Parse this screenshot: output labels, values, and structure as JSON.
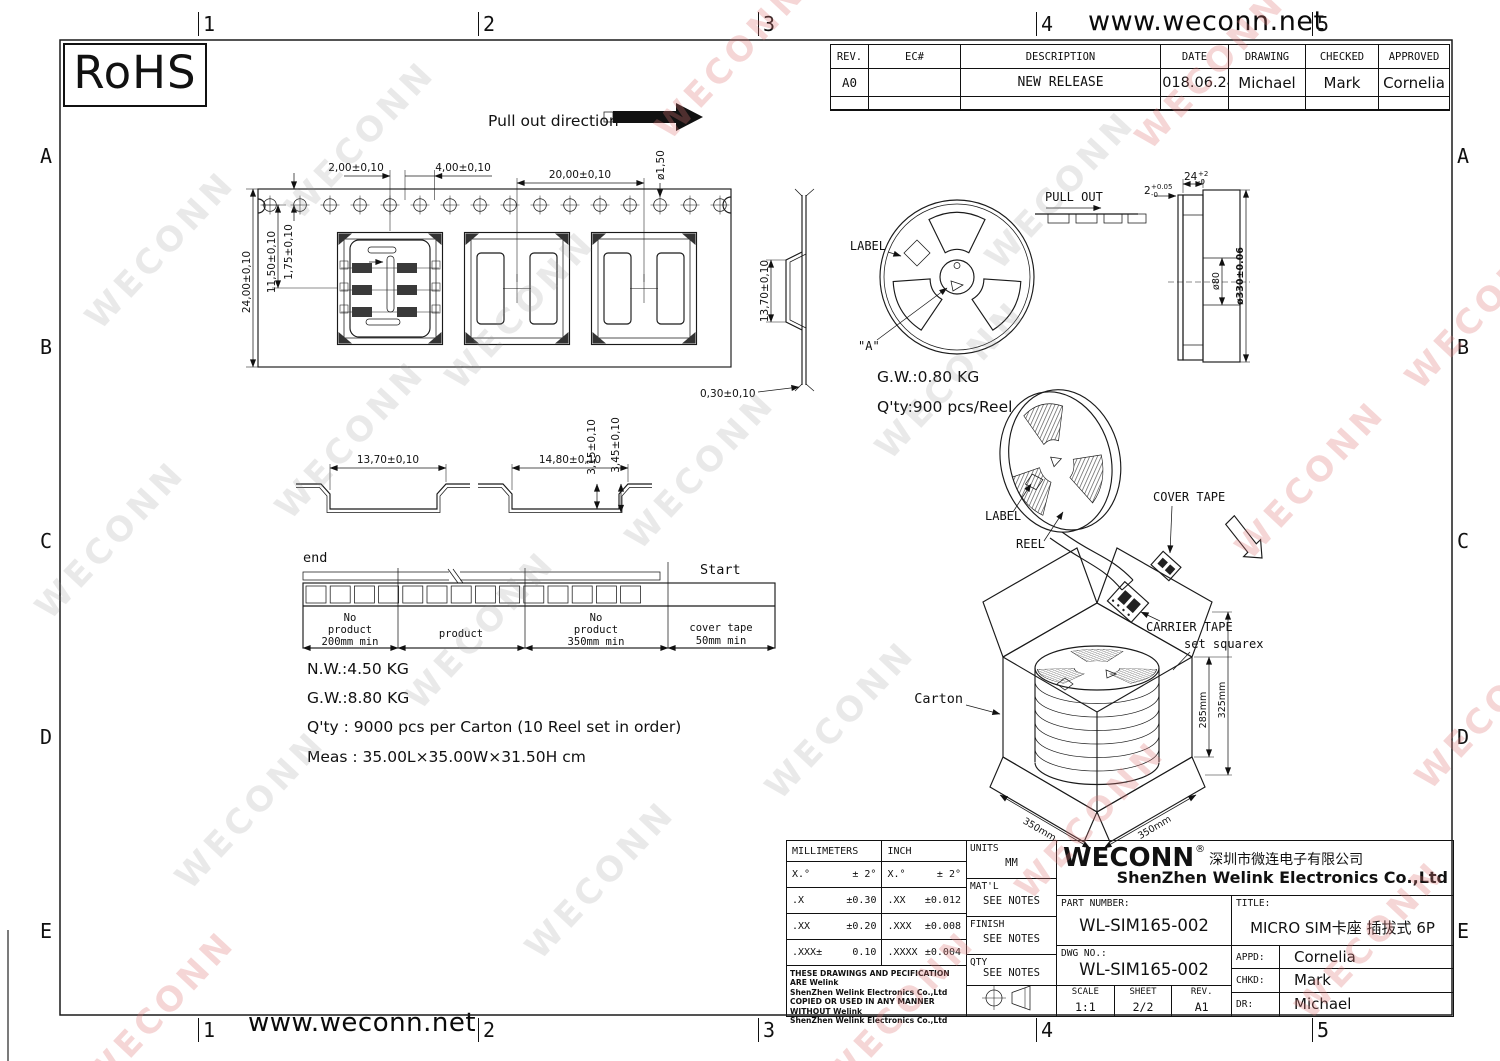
{
  "meta": {
    "watermark": "WECONN"
  },
  "frame": {
    "site_url_top": "www.weconn.net",
    "site_url_bottom": "www.weconn.net",
    "rohs_label": "RoHS",
    "row_labels": [
      "A",
      "B",
      "C",
      "D",
      "E"
    ],
    "col_labels": [
      "1",
      "2",
      "3",
      "4",
      "5"
    ]
  },
  "revision_table": {
    "headers": [
      "REV.",
      "EC#",
      "DESCRIPTION",
      "DATE",
      "DRAWING",
      "CHECKED",
      "APPROVED"
    ],
    "row": {
      "rev": "A0",
      "ec": "",
      "description": "NEW RELEASE",
      "date": "2018.06.24",
      "drawing": "Michael",
      "checked": "Mark",
      "approved": "Cornelia"
    }
  },
  "tape_view": {
    "pull_out_direction": "Pull out direction",
    "dim_hole_offset": "2,00±0,10",
    "dim_hole_pitch": "4,00±0,10",
    "dim_pocket_pitch": "20,00±0,10",
    "dim_hole_dia": "ø1,50",
    "dim_tape_width": "24,00±0,10",
    "dim_pocket_center": "11,50±0,10",
    "dim_hole_edge": "1,75±0,10",
    "dim_pocket_side": "13,70±0,10",
    "dim_tape_thick": "0,30±0,10"
  },
  "section_view": {
    "dim_width_a": "13,70±0,10",
    "dim_width_b": "14,80±0,10",
    "dim_depth_a": "3,15±0,10",
    "dim_depth_b": "3,45±0,10"
  },
  "leader_diagram": {
    "end_label": "end",
    "start_label": "Start",
    "segments": [
      {
        "lines": [
          "No",
          "product",
          "200mm min"
        ]
      },
      {
        "lines": [
          "product"
        ]
      },
      {
        "lines": [
          "No",
          "product",
          "350mm min"
        ]
      },
      {
        "lines": [
          "cover tape",
          "50mm min"
        ]
      }
    ]
  },
  "packing_notes": {
    "nw": "N.W.:4.50 KG",
    "gw": "G.W.:8.80 KG",
    "qty": "Q'ty : 9000 pcs per Carton (10 Reel set in order)",
    "meas": "Meas : 35.00L×35.00W×31.50H cm"
  },
  "reel_front": {
    "label": "LABEL",
    "a_mark": "\"A\"",
    "pull_out": "PULL OUT",
    "gw": "G.W.:0.80 KG",
    "qty": "Q'ty:900 pcs/Reel"
  },
  "reel_side": {
    "w_val": "24",
    "w_up": "+2",
    "w_dn": "-0",
    "t_val": "2",
    "t_up": "+0.05",
    "t_dn": "-0",
    "hub": "ø80",
    "od": "ø330±0.06"
  },
  "packaging_3d": {
    "cover_tape": "COVER TAPE",
    "label": "LABEL",
    "reel": "REEL",
    "carrier_tape": "CARRIER TAPE",
    "set_square": "set squarex",
    "carton": "Carton",
    "dim_l": "350mm",
    "dim_w": "350mm",
    "dim_h_inner": "285mm",
    "dim_h_outer": "325mm"
  },
  "title_block": {
    "tolerance": {
      "col_mm": "MILLIMETERS",
      "col_inch": "INCH",
      "rows": [
        {
          "mm_l": "X.°",
          "mm_v": "± 2°",
          "in_l": "X.°",
          "in_v": "± 2°"
        },
        {
          "mm_l": ".X",
          "mm_v": "±0.30",
          "in_l": ".XX",
          "in_v": "±0.012"
        },
        {
          "mm_l": ".XX",
          "mm_v": "±0.20",
          "in_l": ".XXX",
          "in_v": "±0.008"
        },
        {
          "mm_l": ".XXX±",
          "mm_v": "0.10",
          "in_l": ".XXXX",
          "in_v": "±0.004"
        }
      ],
      "disclaimer_lines": [
        "THESE DRAWINGS AND PECIFICATION ARE Welink",
        "ShenZhen Welink Electronics Co.,Ltd",
        "COPIED OR USED IN ANY MANNER WITHOUT Welink",
        "ShenZhen Welink Electronics Co.,Ltd"
      ]
    },
    "units_label": "UNITS",
    "units_value": "MM",
    "matl_label": "MAT'L",
    "matl_value": "SEE NOTES",
    "finish_label": "FINISH",
    "finish_value": "SEE NOTES",
    "qty_label": "QTY",
    "qty_value": "SEE NOTES",
    "brand": "WECONN",
    "reg_mark": "®",
    "company_cn": "深圳市微连电子有限公司",
    "company_en": "ShenZhen Welink Electronics Co.,Ltd",
    "part_number_label": "PART NUMBER:",
    "part_number": "WL-SIM165-002",
    "title_label": "TITLE:",
    "title": "MICRO SIM卡座 插拔式 6P",
    "dwg_no_label": "DWG NO.:",
    "dwg_no": "WL-SIM165-002",
    "scale_label": "SCALE",
    "scale": "1:1",
    "sheet_label": "SHEET",
    "sheet": "2/2",
    "rev_label": "REV.",
    "rev": "A1",
    "appd_label": "APPD:",
    "appd": "Cornelia",
    "chkd_label": "CHKD:",
    "chkd": "Mark",
    "dr_label": "DR:",
    "dr": "Michael"
  }
}
